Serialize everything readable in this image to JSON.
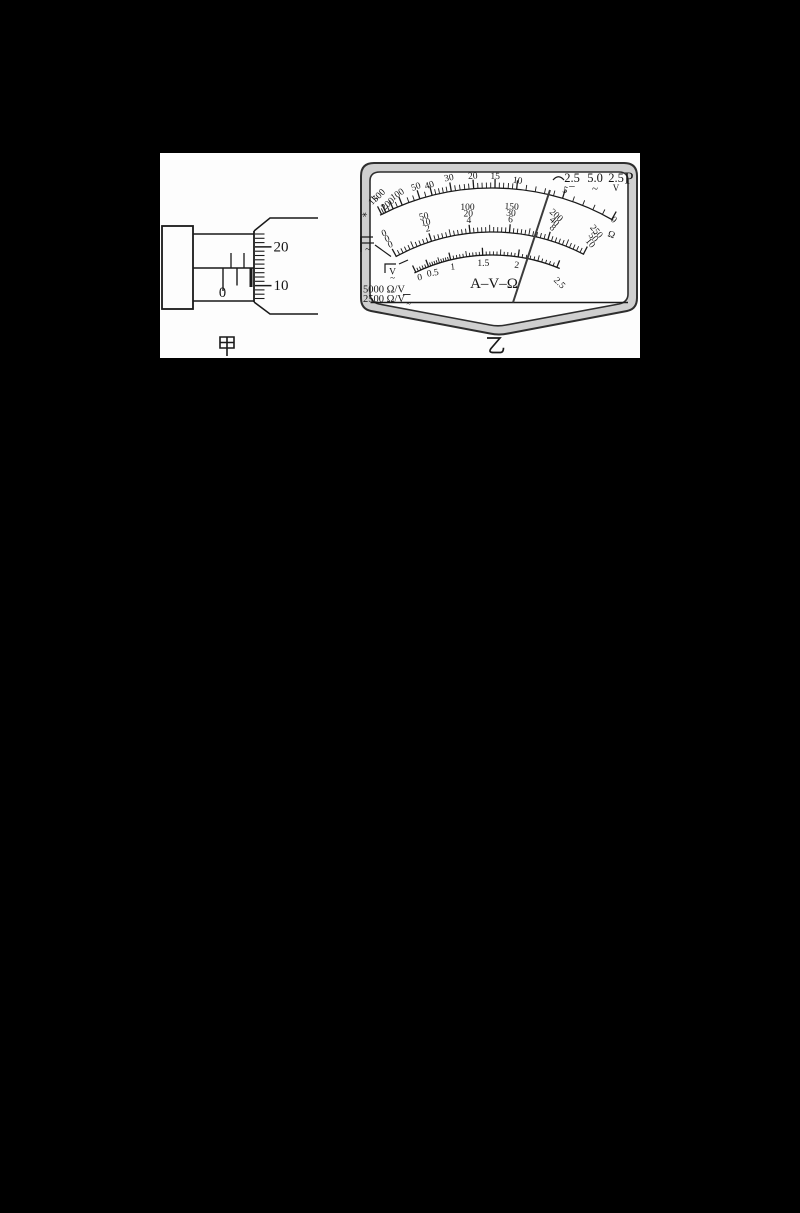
{
  "figure": {
    "left_caption": "甲",
    "right_caption": "乙"
  },
  "micrometer": {
    "zero_label": "0",
    "thimble_major_labels": [
      "20",
      "10"
    ],
    "sleeve_upper_ticks": [
      231,
      244
    ],
    "sleeve_lower_ticks": [
      {
        "x": 223,
        "y2": 291,
        "w": 1.4
      },
      {
        "x": 237,
        "y2": 285.5,
        "w": 1.4
      },
      {
        "x": 251,
        "y2": 287,
        "w": 3
      }
    ],
    "thimble": {
      "x": 255,
      "minor_end": 264.5,
      "major_end": 271.5,
      "y0": 234,
      "step": 4.3,
      "count": 16,
      "major_idx": [
        3,
        12
      ],
      "label_x": 273.5
    }
  },
  "multimeter": {
    "corner": {
      "arc_symbol": "⌒",
      "dc_value": "2.5",
      "dc_symbol": "−",
      "ac_value": "5.0",
      "ac_symbol": "~",
      "v_value": "2.5",
      "v_unit": "V",
      "p": "P"
    },
    "center_label": "A–V–Ω",
    "sensitivity": [
      "5000 Ω/V",
      "2500 Ω/V"
    ],
    "symbols": {
      "acdc_bar": "−",
      "acdc_tilde": "~",
      "volt_letter": "V",
      "volt_tilde": "~",
      "sens_tilde": "~"
    },
    "needle": {
      "x1": 513,
      "y1": 302.5,
      "x2": 550,
      "y2": 190
    },
    "center": {
      "x": 492,
      "y": 432
    },
    "scales": [
      {
        "id": "ohm",
        "line_r": 244,
        "a0": -27.3,
        "a1": 29.8,
        "major_len": 9,
        "minor_len": 5.5,
        "font": 9.5,
        "major_angles": [
          -26.9,
          -25.8,
          -23.9,
          -21.6,
          -17.2,
          -14.2,
          -9.6,
          -4.3,
          0.7,
          5.8,
          16.8,
          29.4
        ],
        "minor_angles": [
          -26.35,
          -24.9,
          -22.8,
          -19.9,
          -18.55,
          -15.7,
          -13.3,
          -12.4,
          -11.5,
          -10.6,
          -8.6,
          -7.5,
          -6.4,
          -5.4,
          -3.3,
          -2.3,
          -1.3,
          -0.3,
          1.7,
          2.7,
          3.8,
          4.8,
          8.0,
          10.2,
          12.4,
          14.6,
          19.3,
          21.8,
          24.4,
          26.9
        ],
        "labels": [
          {
            "t": "1k",
            "a": -26.9,
            "r": 258,
            "rot": -48
          },
          {
            "t": "500",
            "a": -25.4,
            "r": 259.5,
            "rot": -44
          },
          {
            "t": "200",
            "a": -24.4,
            "r": 248,
            "rot": -42
          },
          {
            "t": "100",
            "a": -21.6,
            "r": 253,
            "rot": -34
          },
          {
            "t": "50",
            "a": -17.2,
            "r": 254,
            "rot": -20
          },
          {
            "t": "40",
            "a": -14.2,
            "r": 252,
            "rot": -17
          },
          {
            "t": "30",
            "a": -9.6,
            "r": 255,
            "rot": -11
          },
          {
            "t": "20",
            "a": -4.3,
            "r": 254,
            "rot": -4
          },
          {
            "t": "15",
            "a": 0.7,
            "r": 253,
            "rot": 1
          },
          {
            "t": "10",
            "a": 5.8,
            "r": 250,
            "rot": 8
          },
          {
            "t": "5",
            "a": 16.8,
            "r": 250,
            "rot": 20
          },
          {
            "t": "0",
            "a": 29.7,
            "r": 242,
            "rot": 42
          },
          {
            "t": "Ω",
            "a": 31.3,
            "r": 228,
            "rot": 22
          },
          {
            "t": "∗",
            "a": -30.4,
            "r": 249,
            "rot": -30
          }
        ]
      },
      {
        "id": "dc",
        "line_r": 200,
        "a0": -28.8,
        "a1": 27.4,
        "major_len": 8.5,
        "minor_len": 5,
        "font": 9.5,
        "major_angles": [
          -28.6,
          -17.6,
          -6.3,
          5.0,
          16.2,
          27.2
        ],
        "minor_per_interval": 9,
        "rows": [
          {
            "r": 223.5,
            "values": [
              "0",
              "50",
              "100",
              "150",
              "200",
              "250"
            ]
          },
          {
            "r": 217,
            "values": [
              "0",
              "10",
              "20",
              "30",
              "40",
              "50"
            ]
          },
          {
            "r": 210.5,
            "values": [
              "0",
              "2",
              "4",
              "6",
              "8",
              "10"
            ]
          }
        ],
        "row_rots": [
          -20,
          -12,
          0,
          3,
          42,
          50
        ]
      },
      {
        "id": "ac",
        "line_r": 177,
        "a0": -26,
        "a1": 22.5,
        "major_len": 7.5,
        "minor_len": 3.6,
        "font": 9.5,
        "major_angles": [
          -25.5,
          -21,
          -13.5,
          -3,
          8.5,
          21.5
        ],
        "minor_plan": [
          4,
          9,
          9,
          9,
          9
        ],
        "labels": [
          {
            "t": "0",
            "a": -25.3,
            "r": 168,
            "rot": -10
          },
          {
            "t": "0.5",
            "a": -20.6,
            "r": 167,
            "rot": -10
          },
          {
            "t": "1",
            "a": -13.5,
            "r": 167,
            "rot": -6
          },
          {
            "t": "1.5",
            "a": -3,
            "r": 166,
            "rot": 0
          },
          {
            "t": "2",
            "a": 8.5,
            "r": 166,
            "rot": 6
          },
          {
            "t": "2.5",
            "a": 24,
            "r": 161,
            "rot": 45
          }
        ]
      }
    ]
  }
}
